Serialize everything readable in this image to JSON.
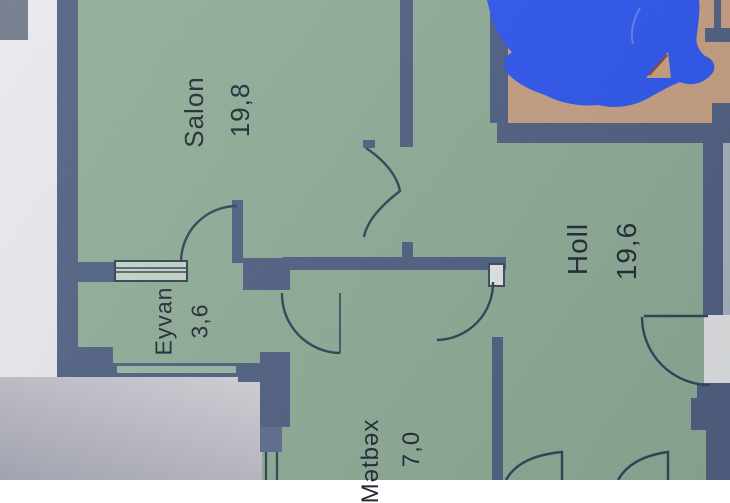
{
  "photo": {
    "description": "Photographed apartment floor plan with a blue pen scribble over the balcony room"
  },
  "rooms": [
    {
      "id": "salon",
      "label": "Salon",
      "area": "19,8"
    },
    {
      "id": "eyvan",
      "label": "Eyvan",
      "area": "3,6"
    },
    {
      "id": "holl",
      "label": "Holl",
      "area": "19,6"
    },
    {
      "id": "metbex",
      "label": "Mətbəx",
      "area": "7,0"
    }
  ],
  "colors": {
    "floor_green": "#8fae97",
    "wall_blue": "#4f5f81",
    "line_dark": "#2e4254",
    "balcony_beige": "#c9a182",
    "scribble_blue": "#2b55f2",
    "paper": "#e9eaee",
    "margin_slate": "#a9b4c2",
    "label_text": "#222b36"
  }
}
